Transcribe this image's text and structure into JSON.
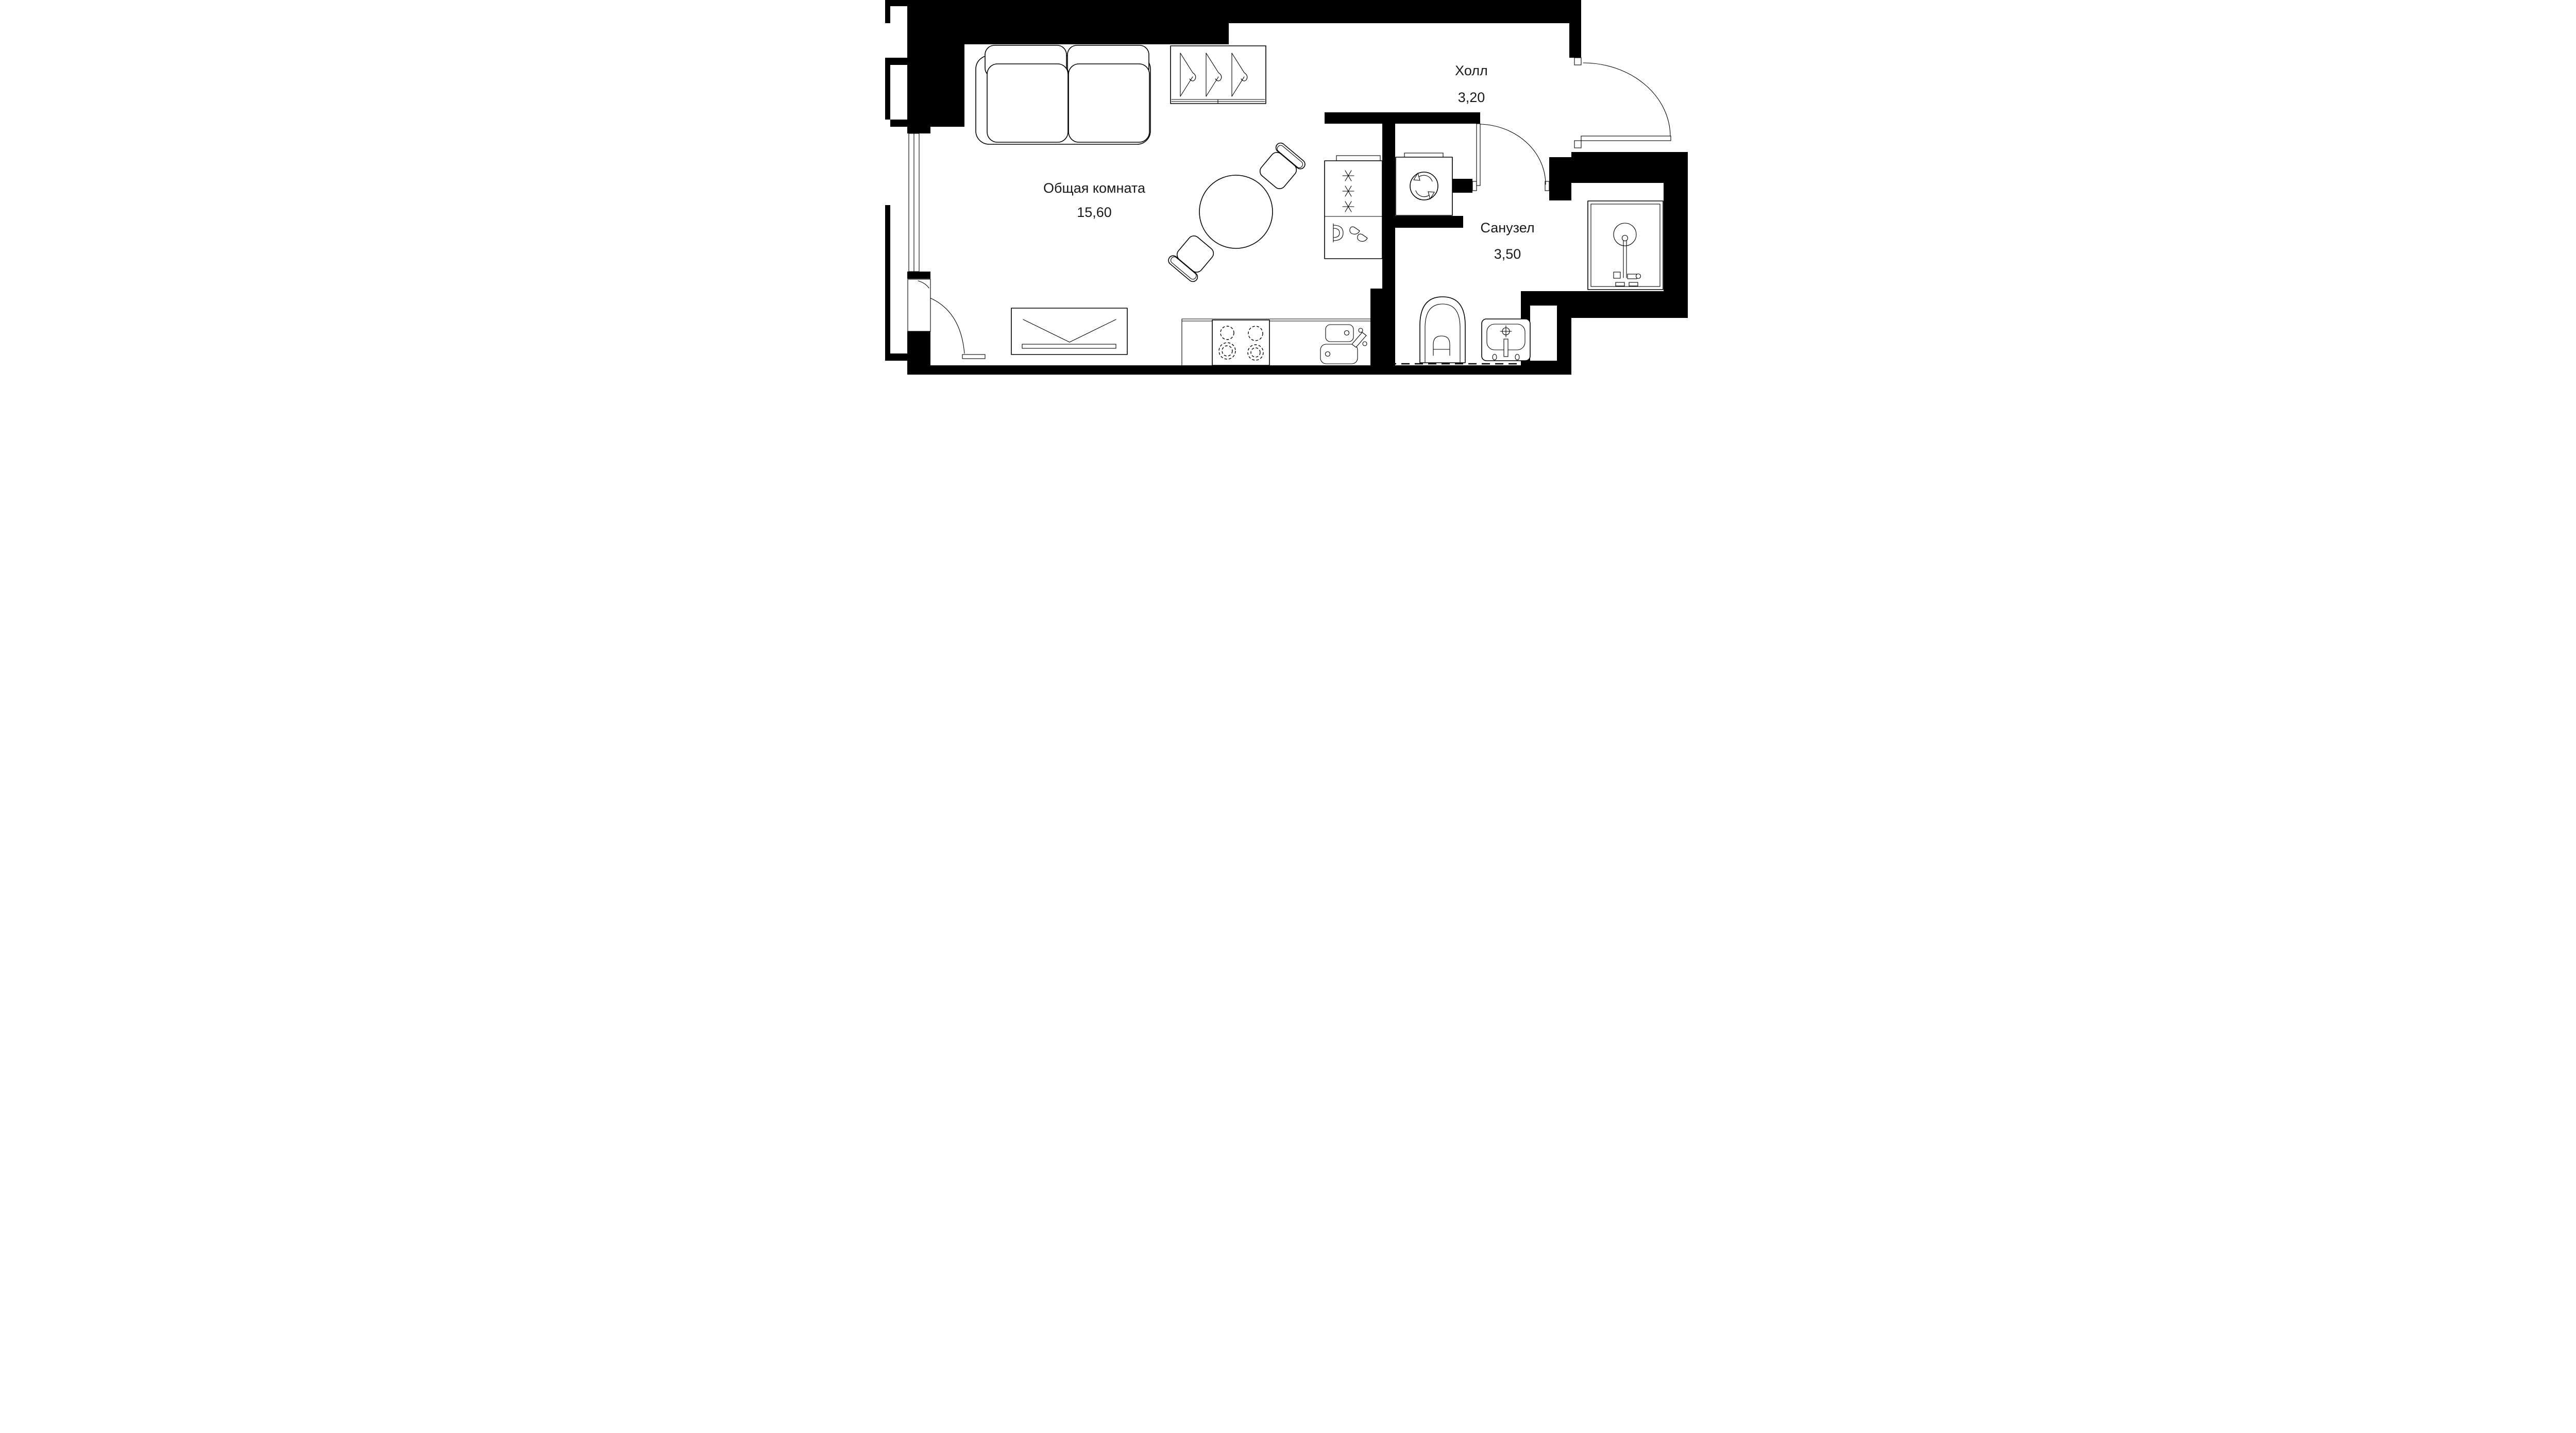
{
  "plan": {
    "type": "apartment-floor-plan",
    "rooms": [
      {
        "id": "living",
        "name": "Общая комната",
        "area": "15,60"
      },
      {
        "id": "hall",
        "name": "Холл",
        "area": "3,20"
      },
      {
        "id": "bathroom",
        "name": "Санузел",
        "area": "3,50"
      }
    ],
    "fixtures": [
      "sofa",
      "wardrobe-hangers",
      "dining-table",
      "chair",
      "tv-stand",
      "refrigerator-freezer",
      "washing-machine",
      "stove",
      "kitchen-sink",
      "toilet",
      "wash-basin",
      "shower-cabin",
      "entrance-door",
      "bathroom-door",
      "balcony-door"
    ],
    "icons": {
      "snowflake": "freezer-section",
      "drops": "fridge-section",
      "rotating-drum": "washing-machine",
      "hanger": "wardrobe",
      "crosshair": "basin-faucet"
    },
    "colors": {
      "walls": "#000000",
      "lines": "#000000",
      "background": "#ffffff"
    }
  }
}
